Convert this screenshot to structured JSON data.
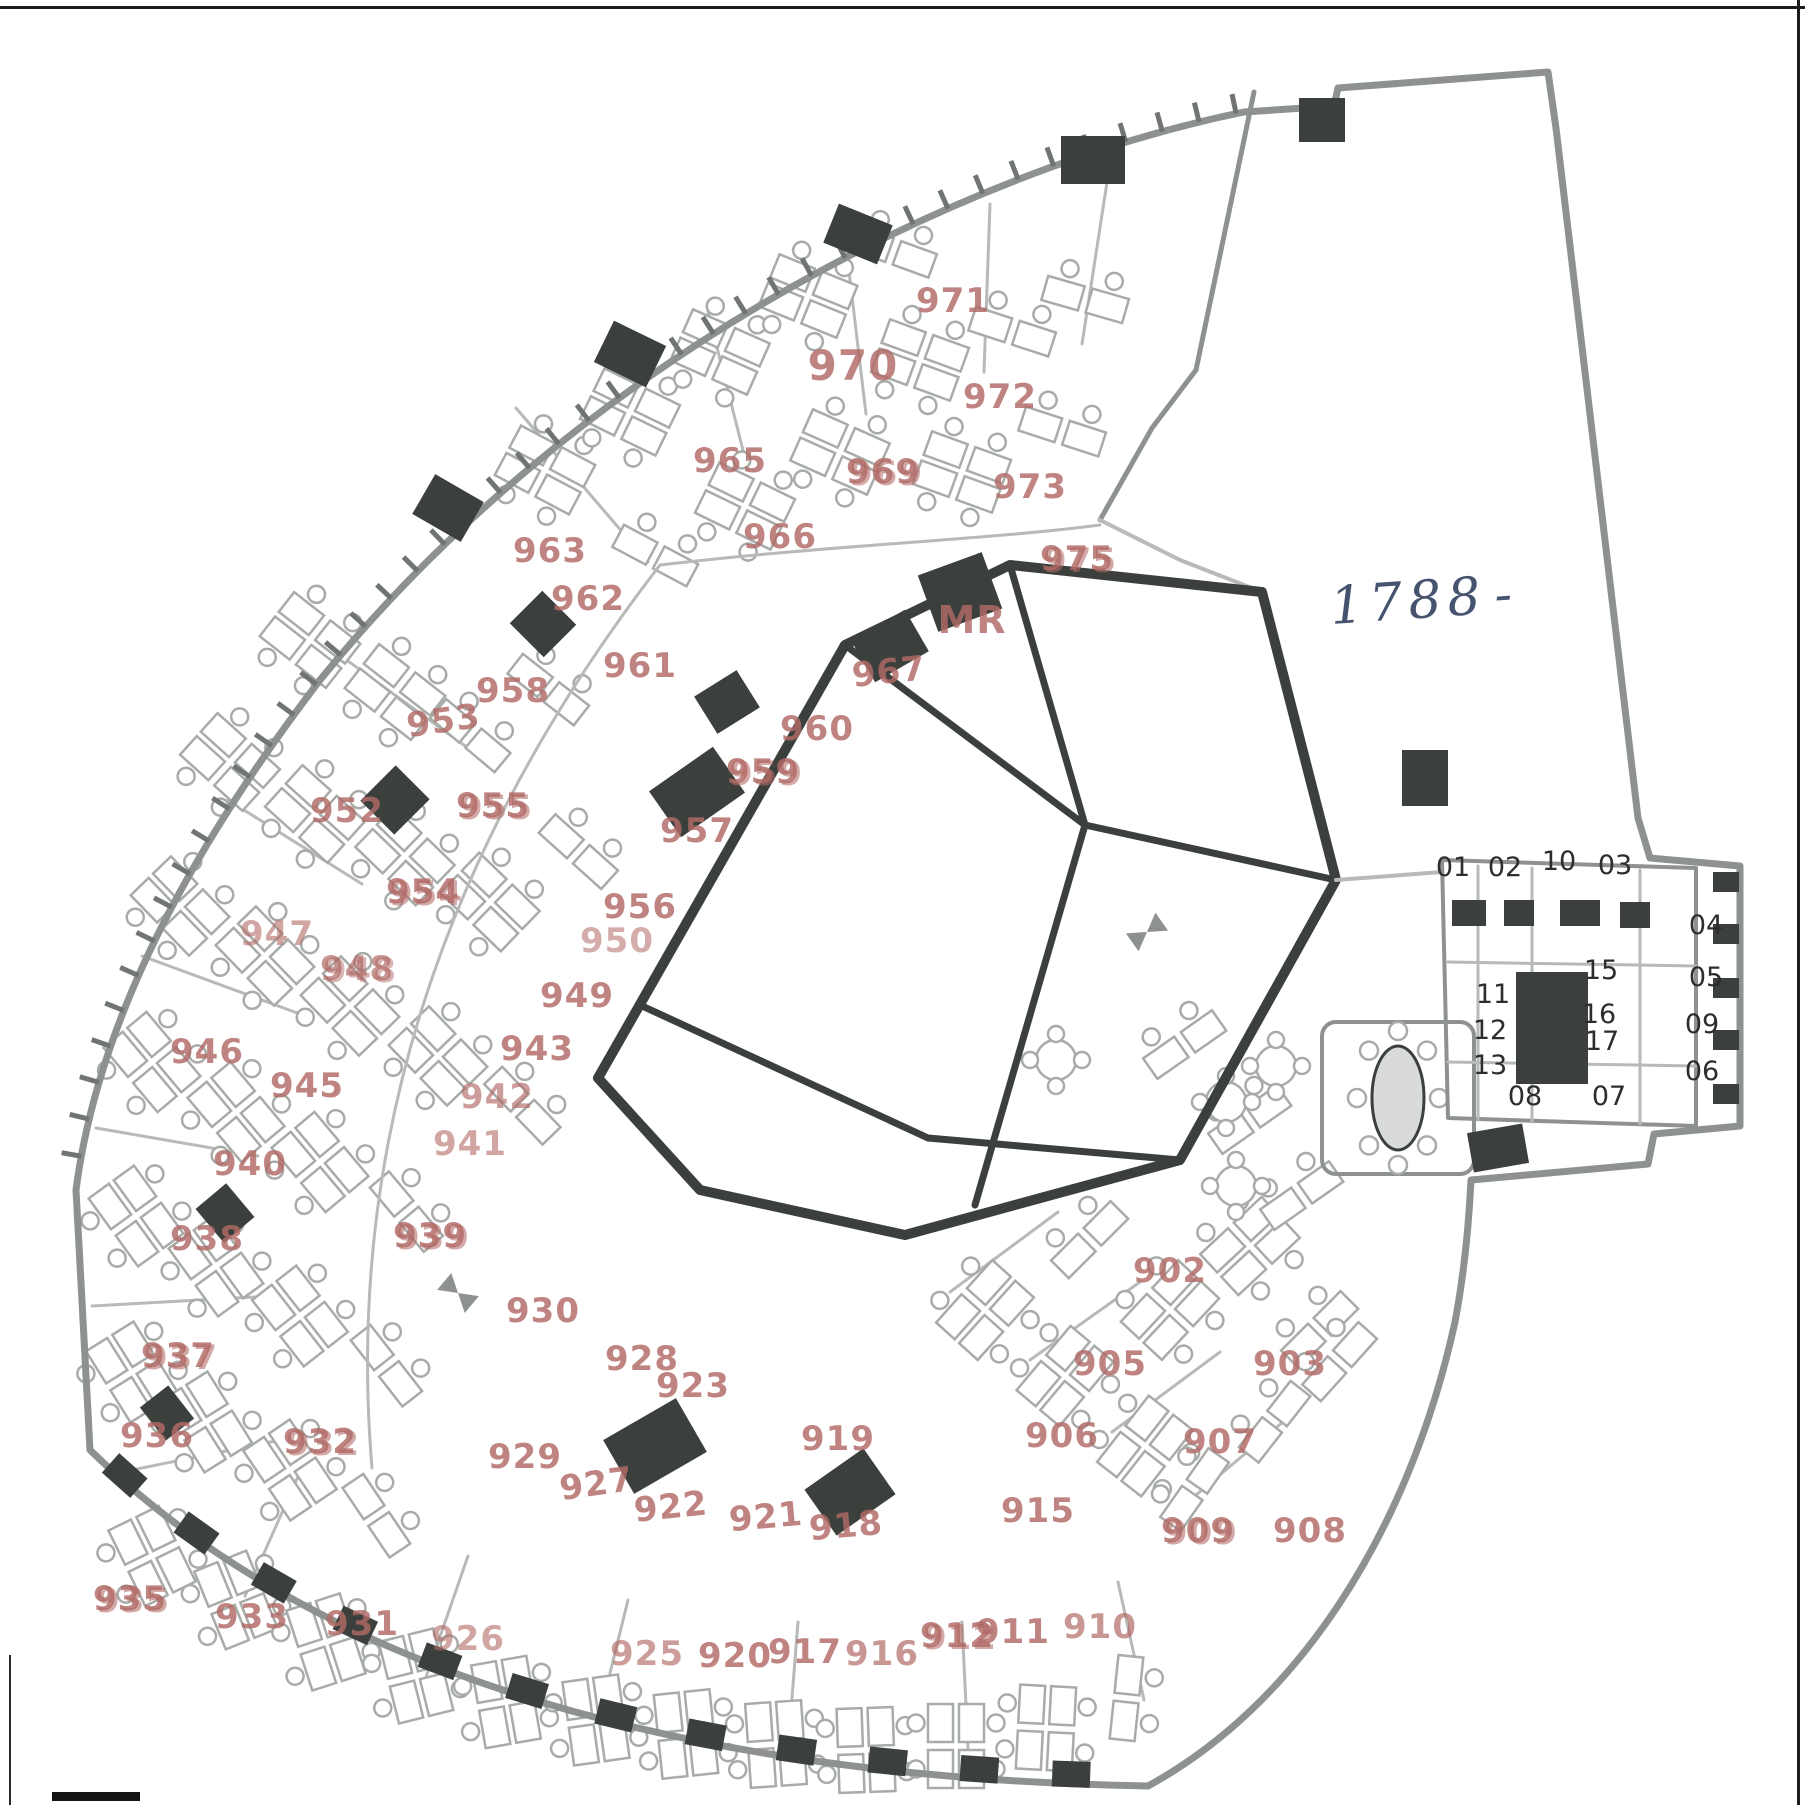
{
  "colors": {
    "paper": "#ffffff",
    "wall_gray": "#8e928f",
    "wall_light": "#b7bab8",
    "wall_dark": "#3b403d",
    "desk_gray": "#a8aca9",
    "label_red": "#b16a66",
    "unit_dark": "#2d2d2d",
    "handwriting_blue": "#45536e",
    "tick_gray": "#707573"
  },
  "annotations": {
    "handwritten": "1788"
  },
  "plan": {
    "room_labels": [
      {
        "t": "971",
        "x": 953,
        "y": 312
      },
      {
        "t": "970",
        "x": 853,
        "y": 380,
        "s": 42
      },
      {
        "t": "972",
        "x": 1000,
        "y": 408
      },
      {
        "t": "969",
        "x": 883,
        "y": 483,
        "d": 1
      },
      {
        "t": "965",
        "x": 730,
        "y": 472
      },
      {
        "t": "973",
        "x": 1030,
        "y": 498
      },
      {
        "t": "966",
        "x": 780,
        "y": 548
      },
      {
        "t": "975",
        "x": 1077,
        "y": 570,
        "d": 1
      },
      {
        "t": "963",
        "x": 550,
        "y": 562
      },
      {
        "t": "962",
        "x": 588,
        "y": 610
      },
      {
        "t": "961",
        "x": 640,
        "y": 677
      },
      {
        "t": "958",
        "x": 513,
        "y": 702
      },
      {
        "t": "953",
        "x": 445,
        "y": 732,
        "r": -8
      },
      {
        "t": "967",
        "x": 890,
        "y": 683,
        "r": -6
      },
      {
        "t": "MR",
        "x": 972,
        "y": 633,
        "s": 38
      },
      {
        "t": "960",
        "x": 817,
        "y": 740
      },
      {
        "t": "959",
        "x": 763,
        "y": 783,
        "d": 1
      },
      {
        "t": "955",
        "x": 493,
        "y": 817,
        "d": 1
      },
      {
        "t": "952",
        "x": 347,
        "y": 822
      },
      {
        "t": "957",
        "x": 697,
        "y": 842
      },
      {
        "t": "954",
        "x": 423,
        "y": 903,
        "d": 1
      },
      {
        "t": "956",
        "x": 640,
        "y": 918
      },
      {
        "t": "950",
        "x": 617,
        "y": 952,
        "o": 0.55
      },
      {
        "t": "949",
        "x": 577,
        "y": 1007
      },
      {
        "t": "947",
        "x": 277,
        "y": 945,
        "o": 0.6
      },
      {
        "t": "948",
        "x": 357,
        "y": 980,
        "d": 1,
        "o": 0.7
      },
      {
        "t": "946",
        "x": 207,
        "y": 1063
      },
      {
        "t": "943",
        "x": 537,
        "y": 1060
      },
      {
        "t": "945",
        "x": 307,
        "y": 1097
      },
      {
        "t": "942",
        "x": 497,
        "y": 1108,
        "o": 0.65
      },
      {
        "t": "941",
        "x": 470,
        "y": 1155,
        "o": 0.6
      },
      {
        "t": "940",
        "x": 250,
        "y": 1175
      },
      {
        "t": "939",
        "x": 430,
        "y": 1247,
        "d": 1
      },
      {
        "t": "938",
        "x": 207,
        "y": 1250
      },
      {
        "t": "930",
        "x": 543,
        "y": 1322
      },
      {
        "t": "928",
        "x": 642,
        "y": 1370
      },
      {
        "t": "923",
        "x": 693,
        "y": 1397
      },
      {
        "t": "902",
        "x": 1170,
        "y": 1282
      },
      {
        "t": "905",
        "x": 1110,
        "y": 1375
      },
      {
        "t": "903",
        "x": 1290,
        "y": 1375
      },
      {
        "t": "929",
        "x": 525,
        "y": 1468
      },
      {
        "t": "927",
        "x": 598,
        "y": 1495,
        "r": -8
      },
      {
        "t": "922",
        "x": 672,
        "y": 1518,
        "r": -6
      },
      {
        "t": "919",
        "x": 838,
        "y": 1450
      },
      {
        "t": "921",
        "x": 767,
        "y": 1528,
        "r": -5
      },
      {
        "t": "918",
        "x": 847,
        "y": 1537,
        "r": -5
      },
      {
        "t": "906",
        "x": 1062,
        "y": 1447
      },
      {
        "t": "907",
        "x": 1220,
        "y": 1453
      },
      {
        "t": "915",
        "x": 1038,
        "y": 1522
      },
      {
        "t": "909",
        "x": 1198,
        "y": 1542,
        "d": 1
      },
      {
        "t": "908",
        "x": 1310,
        "y": 1542
      },
      {
        "t": "937",
        "x": 178,
        "y": 1367,
        "d": 1
      },
      {
        "t": "936",
        "x": 157,
        "y": 1447
      },
      {
        "t": "932",
        "x": 320,
        "y": 1453,
        "d": 1
      },
      {
        "t": "935",
        "x": 130,
        "y": 1610,
        "d": 1
      },
      {
        "t": "933",
        "x": 252,
        "y": 1628
      },
      {
        "t": "931",
        "x": 362,
        "y": 1635
      },
      {
        "t": "926",
        "x": 468,
        "y": 1650,
        "o": 0.6
      },
      {
        "t": "925",
        "x": 647,
        "y": 1665,
        "o": 0.65
      },
      {
        "t": "920",
        "x": 735,
        "y": 1667
      },
      {
        "t": "917",
        "x": 805,
        "y": 1663
      },
      {
        "t": "916",
        "x": 882,
        "y": 1665,
        "o": 0.7
      },
      {
        "t": "912",
        "x": 957,
        "y": 1647,
        "d": 1
      },
      {
        "t": "911",
        "x": 1013,
        "y": 1643
      },
      {
        "t": "910",
        "x": 1100,
        "y": 1638,
        "o": 0.7
      }
    ],
    "unit_labels": [
      {
        "t": "01",
        "x": 1453,
        "y": 876
      },
      {
        "t": "02",
        "x": 1505,
        "y": 876
      },
      {
        "t": "10",
        "x": 1559,
        "y": 870
      },
      {
        "t": "03",
        "x": 1615,
        "y": 874
      },
      {
        "t": "04",
        "x": 1706,
        "y": 934
      },
      {
        "t": "05",
        "x": 1706,
        "y": 986
      },
      {
        "t": "09",
        "x": 1702,
        "y": 1033
      },
      {
        "t": "06",
        "x": 1702,
        "y": 1080
      },
      {
        "t": "11",
        "x": 1493,
        "y": 1003
      },
      {
        "t": "12",
        "x": 1490,
        "y": 1039
      },
      {
        "t": "13",
        "x": 1490,
        "y": 1074
      },
      {
        "t": "15",
        "x": 1601,
        "y": 979
      },
      {
        "t": "16",
        "x": 1599,
        "y": 1023
      },
      {
        "t": "17",
        "x": 1602,
        "y": 1050
      },
      {
        "t": "08",
        "x": 1525,
        "y": 1105
      },
      {
        "t": "07",
        "x": 1609,
        "y": 1105
      }
    ],
    "walls": [
      {
        "d": "M 1548,72 L 1338,88 L 1334,106 L 1244,112 C 960,170 580,360 320,680 C 190,850 98,1020 76,1190 L 90,1450 C 300,1655 640,1777 1148,1786 C 1295,1706 1408,1536 1455,1322 C 1464,1274 1469,1222 1471,1180 L 1648,1164 L 1654,1134 L 1740,1126 L 1740,866 L 1650,858 L 1638,818 L 1556,128 Z",
        "s": "gray",
        "w": 7
      },
      {
        "d": "M 1254,92 L 1196,370 L 1152,428 L 1100,520",
        "s": "gray",
        "w": 5
      },
      {
        "d": "M 1100,520 L 1180,560 L 1262,592",
        "s": "light",
        "w": 4
      },
      {
        "d": "M 660,565 C 440,850 345,1150 372,1468",
        "s": "light",
        "w": 3
      },
      {
        "d": "M 660,565 C 830,545 985,540 1100,525",
        "s": "light",
        "w": 3
      },
      {
        "d": "M 598,1078 L 845,645 L 1010,565 L 1262,592 L 1336,880 L 1180,1160 L 905,1235 L 700,1190 Z",
        "s": "dark",
        "w": 10
      },
      {
        "d": "M 845,645 L 1085,825",
        "s": "dark",
        "w": 7
      },
      {
        "d": "M 1010,565 L 1085,825",
        "s": "dark",
        "w": 7
      },
      {
        "d": "M 1085,825 L 1336,880",
        "s": "dark",
        "w": 7
      },
      {
        "d": "M 1085,825 L 975,1205",
        "s": "dark",
        "w": 7
      },
      {
        "d": "M 640,1005 L 928,1138",
        "s": "dark",
        "w": 7
      },
      {
        "d": "M 928,1138 L 1180,1160",
        "s": "dark",
        "w": 7
      },
      {
        "d": "M 1336,880 L 1442,872",
        "s": "light",
        "w": 4
      },
      {
        "d": "M 1442,860 L 1696,868 L 1696,1126 L 1448,1118 Z",
        "s": "gray",
        "w": 4
      },
      {
        "d": "M 1478,866 L 1478,1120",
        "s": "light",
        "w": 3
      },
      {
        "d": "M 1532,868 L 1532,1122",
        "s": "light",
        "w": 3
      },
      {
        "d": "M 1640,870 L 1640,1124",
        "s": "light",
        "w": 3
      },
      {
        "d": "M 1448,962 L 1696,966",
        "s": "light",
        "w": 3
      },
      {
        "d": "M 1448,1062 L 1696,1066",
        "s": "light",
        "w": 3
      }
    ],
    "tick_path": "M 1244,112 C 960,170 580,360 320,680 C 190,850 98,1020 76,1190",
    "bottom_path": "M 110,1462 C 310,1650 640,1768 1140,1776",
    "partitions": [
      [
        516,
        408,
        648,
        562
      ],
      [
        330,
        648,
        468,
        748
      ],
      [
        228,
        800,
        362,
        884
      ],
      [
        142,
        956,
        300,
        1014
      ],
      [
        96,
        1128,
        258,
        1156
      ],
      [
        92,
        1306,
        272,
        1296
      ],
      [
        122,
        1472,
        300,
        1436
      ],
      [
        708,
        312,
        748,
        470
      ],
      [
        846,
        246,
        866,
        414
      ],
      [
        990,
        204,
        984,
        372
      ],
      [
        1108,
        176,
        1082,
        344
      ],
      [
        245,
        1596,
        300,
        1472
      ],
      [
        425,
        1680,
        468,
        1556
      ],
      [
        598,
        1722,
        628,
        1600
      ],
      [
        788,
        1748,
        798,
        1622
      ],
      [
        968,
        1748,
        962,
        1622
      ],
      [
        1144,
        1700,
        1118,
        1582
      ],
      [
        950,
        1292,
        1058,
        1212
      ],
      [
        1030,
        1360,
        1140,
        1282
      ],
      [
        1112,
        1432,
        1220,
        1352
      ],
      [
        1190,
        1500,
        1290,
        1416
      ]
    ],
    "blobs": [
      [
        1093,
        160,
        64,
        48,
        0
      ],
      [
        1322,
        120,
        46,
        44,
        0
      ],
      [
        858,
        234,
        58,
        42,
        22
      ],
      [
        630,
        354,
        58,
        46,
        26
      ],
      [
        448,
        508,
        56,
        46,
        30
      ],
      [
        543,
        624,
        48,
        46,
        45
      ],
      [
        395,
        800,
        48,
        50,
        45
      ],
      [
        225,
        1213,
        44,
        40,
        50
      ],
      [
        167,
        1413,
        42,
        36,
        52
      ],
      [
        960,
        592,
        68,
        60,
        -20
      ],
      [
        890,
        646,
        62,
        48,
        -30
      ],
      [
        727,
        702,
        50,
        44,
        -32
      ],
      [
        697,
        792,
        78,
        56,
        -35
      ],
      [
        655,
        1446,
        84,
        62,
        -30
      ],
      [
        850,
        1492,
        72,
        56,
        -35
      ],
      [
        1425,
        778,
        46,
        56,
        0
      ],
      [
        1498,
        1148,
        56,
        40,
        -10
      ],
      [
        1552,
        1028,
        72,
        112,
        0
      ],
      [
        1726,
        882,
        26,
        20,
        0
      ],
      [
        1726,
        934,
        26,
        20,
        0
      ],
      [
        1726,
        988,
        26,
        20,
        0
      ],
      [
        1726,
        1040,
        26,
        20,
        0
      ],
      [
        1726,
        1094,
        26,
        20,
        0
      ],
      [
        1469,
        913,
        34,
        26,
        0
      ],
      [
        1519,
        913,
        30,
        26,
        0
      ],
      [
        1580,
        913,
        40,
        26,
        0
      ],
      [
        1635,
        915,
        30,
        26,
        0
      ]
    ],
    "clusters": [
      [
        545,
        470,
        28,
        "q"
      ],
      [
        630,
        412,
        26,
        "q"
      ],
      [
        720,
        352,
        24,
        "q"
      ],
      [
        808,
        296,
        22,
        "q"
      ],
      [
        893,
        252,
        20,
        "d"
      ],
      [
        920,
        360,
        20,
        "q"
      ],
      [
        1012,
        332,
        18,
        "d"
      ],
      [
        840,
        452,
        24,
        "q"
      ],
      [
        745,
        506,
        26,
        "q"
      ],
      [
        655,
        556,
        28,
        "d"
      ],
      [
        1062,
        432,
        18,
        "d"
      ],
      [
        962,
        472,
        20,
        "q"
      ],
      [
        1085,
        300,
        16,
        "d"
      ],
      [
        310,
        640,
        38,
        "q"
      ],
      [
        395,
        692,
        38,
        "q"
      ],
      [
        230,
        762,
        42,
        "q"
      ],
      [
        315,
        814,
        42,
        "q"
      ],
      [
        470,
        736,
        40,
        "d"
      ],
      [
        548,
        690,
        38,
        "d"
      ],
      [
        405,
        856,
        44,
        "q"
      ],
      [
        490,
        902,
        44,
        "q"
      ],
      [
        578,
        852,
        42,
        "d"
      ],
      [
        180,
        906,
        46,
        "q"
      ],
      [
        265,
        956,
        46,
        "q"
      ],
      [
        350,
        1006,
        46,
        "q"
      ],
      [
        438,
        1056,
        46,
        "q"
      ],
      [
        522,
        1106,
        46,
        "d"
      ],
      [
        152,
        1062,
        50,
        "q"
      ],
      [
        236,
        1112,
        50,
        "q"
      ],
      [
        320,
        1162,
        50,
        "q"
      ],
      [
        406,
        1212,
        50,
        "d"
      ],
      [
        136,
        1216,
        54,
        "q"
      ],
      [
        216,
        1266,
        54,
        "q"
      ],
      [
        300,
        1316,
        52,
        "q"
      ],
      [
        386,
        1366,
        52,
        "d"
      ],
      [
        132,
        1372,
        58,
        "q"
      ],
      [
        206,
        1422,
        58,
        "q"
      ],
      [
        290,
        1470,
        56,
        "q"
      ],
      [
        376,
        1516,
        56,
        "d"
      ],
      [
        152,
        1556,
        64,
        "q"
      ],
      [
        236,
        1600,
        68,
        "q"
      ],
      [
        326,
        1642,
        72,
        "q"
      ],
      [
        416,
        1676,
        76,
        "q"
      ],
      [
        506,
        1702,
        80,
        "q"
      ],
      [
        596,
        1720,
        82,
        "q"
      ],
      [
        686,
        1734,
        84,
        "q"
      ],
      [
        776,
        1744,
        86,
        "q"
      ],
      [
        866,
        1750,
        88,
        "q"
      ],
      [
        956,
        1746,
        90,
        "q"
      ],
      [
        1046,
        1728,
        93,
        "q"
      ],
      [
        1126,
        1698,
        96,
        "d"
      ],
      [
        985,
        1310,
        -48,
        "q"
      ],
      [
        1065,
        1376,
        -50,
        "q"
      ],
      [
        1145,
        1446,
        -52,
        "q"
      ],
      [
        1090,
        1240,
        -45,
        "d"
      ],
      [
        1170,
        1310,
        -47,
        "q"
      ],
      [
        1250,
        1246,
        -43,
        "q"
      ],
      [
        1320,
        1330,
        -45,
        "d"
      ],
      [
        1195,
        1490,
        -55,
        "d"
      ],
      [
        1275,
        1422,
        -52,
        "d"
      ],
      [
        1340,
        1362,
        -48,
        "d"
      ],
      [
        1185,
        1045,
        -35,
        "d"
      ],
      [
        1250,
        1120,
        -35,
        "d"
      ],
      [
        1302,
        1196,
        -35,
        "d"
      ]
    ],
    "round_tables": [
      [
        1056,
        1060
      ],
      [
        1226,
        1102
      ],
      [
        1276,
        1066
      ],
      [
        1236,
        1186
      ]
    ],
    "bowties": [
      [
        1147,
        932,
        -35
      ],
      [
        458,
        1293,
        40
      ]
    ],
    "conference": {
      "x": 1322,
      "y": 1022,
      "w": 152,
      "h": 152,
      "table": {
        "cx": 1398,
        "cy": 1098,
        "rx": 26,
        "ry": 52
      },
      "chairs": 8
    }
  }
}
